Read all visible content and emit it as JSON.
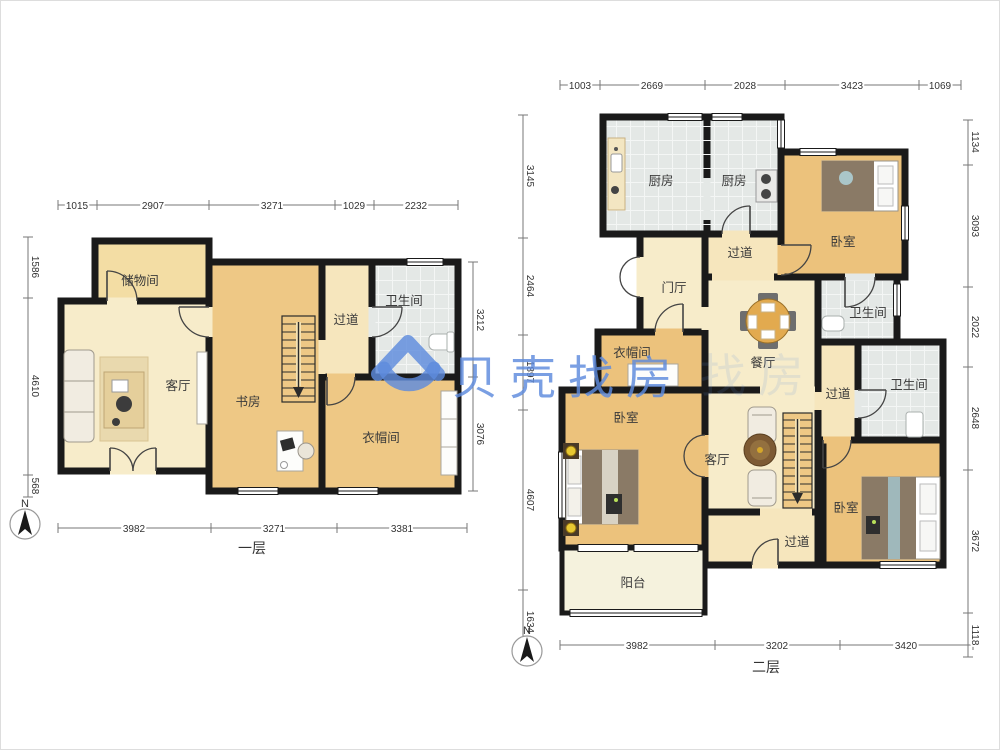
{
  "watermark": {
    "brand": "贝壳找房",
    "echo": "找房",
    "color": "#5e8bdd",
    "logo": "beike-house-icon"
  },
  "compass": {
    "north_label": "N"
  },
  "floor1": {
    "title": "一层",
    "rooms": {
      "storage": "储物间",
      "living": "客厅",
      "study": "书房",
      "hallway": "过道",
      "bath": "卫生间",
      "cloak": "衣帽间"
    },
    "dims": {
      "top": [
        "1015",
        "2907",
        "3271",
        "1029",
        "2232"
      ],
      "bottom": [
        "3982",
        "3271",
        "3381"
      ],
      "left": [
        "1586",
        "4610",
        "568"
      ],
      "right": [
        "3212",
        "3076"
      ]
    }
  },
  "floor2": {
    "title": "二层",
    "rooms": {
      "kitchen1": "厨房",
      "kitchen2": "厨房",
      "bedroom_top": "卧室",
      "corridor_top": "过道",
      "foyer": "门厅",
      "dining": "餐厅",
      "bath_top": "卫生间",
      "cloak": "衣帽间",
      "corridor_right": "过道",
      "bath_right": "卫生间",
      "bedroom_left": "卧室",
      "living": "客厅",
      "corridor_bottom": "过道",
      "bedroom_right": "卧室",
      "balcony": "阳台"
    },
    "dims": {
      "top": [
        "1003",
        "2669",
        "2028",
        "3423",
        "1069"
      ],
      "bottom": [
        "3982",
        "3202",
        "3420"
      ],
      "left": [
        "3145",
        "2464",
        "1897",
        "4607",
        "1634"
      ],
      "right": [
        "1134",
        "3093",
        "2022",
        "2648",
        "3672",
        "1118"
      ]
    }
  },
  "colors": {
    "wall": "#1a1a1a",
    "wood": "#ecc27c",
    "wood_light": "#f3dda4",
    "cream": "#f7ecca",
    "cream2": "#f6e6bd",
    "tile": "#e4e8e6",
    "balcony": "#f5f2dd",
    "watermark": "#5e8bdd"
  }
}
